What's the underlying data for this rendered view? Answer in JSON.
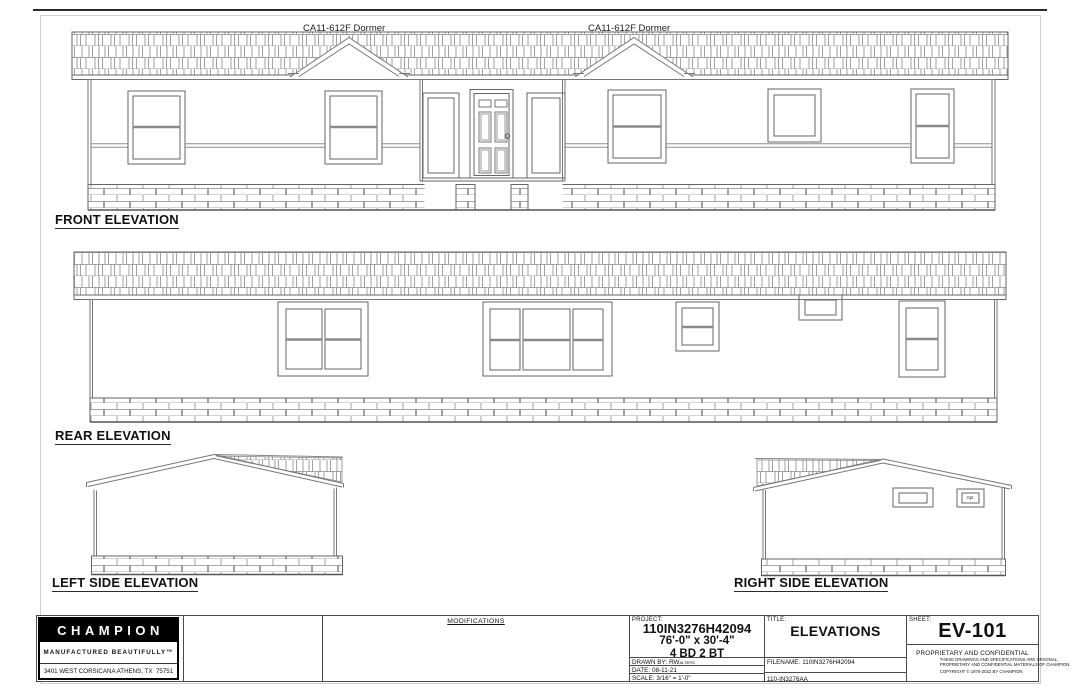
{
  "sheet": {
    "background": "#ffffff",
    "line_color": "#777777",
    "text_color": "#111111"
  },
  "drawings": {
    "front": {
      "label": "FRONT ELEVATION",
      "dormer_label": "CA11-612F Dormer"
    },
    "rear": {
      "label": "REAR ELEVATION"
    },
    "left_side": {
      "label": "LEFT SIDE ELEVATION"
    },
    "right_side": {
      "label": "RIGHT SIDE ELEVATION",
      "vent_label": "Opt"
    }
  },
  "title_block": {
    "company": {
      "name": "CHAMPION",
      "tagline": "MANUFACTURED BEAUTIFULLY™",
      "address": "3401 WEST CORSICANA ATHENS, TX  75751"
    },
    "modifications": {
      "header": "MODIFICATIONS"
    },
    "project": {
      "label": "PROJECT:",
      "number": "110IN3276H42094",
      "dimensions": "76'-0\" x 30'-4\"",
      "bed_bath": "4 BD 2 BT"
    },
    "drawn_by": {
      "label": "DRAWN BY:",
      "value": "RWalters"
    },
    "date": {
      "label": "DATE:",
      "value": "08-11-21"
    },
    "scale": {
      "label": "SCALE:",
      "value": "3/16\" = 1'-0\""
    },
    "sheet_title": {
      "label": "TITLE:",
      "value": "ELEVATIONS"
    },
    "filename": {
      "label": "FILENAME:",
      "value": "110IN3276H42094"
    },
    "file_code": "110-IN3276AA",
    "sheet_number": {
      "label": "SHEET:",
      "value": "EV-101"
    },
    "legal": {
      "line1": "PROPRIETARY AND CONFIDENTIAL",
      "line2": "THESE DRAWINGS AND SPECIFICATIONS ARE ORIGINAL,",
      "line3": "PROPRIETARY AND CONFIDENTIAL MATERIALS OF CHAMPION.",
      "line4": "COPYRIGHT © 1976-2022 BY CHAMPION"
    }
  }
}
